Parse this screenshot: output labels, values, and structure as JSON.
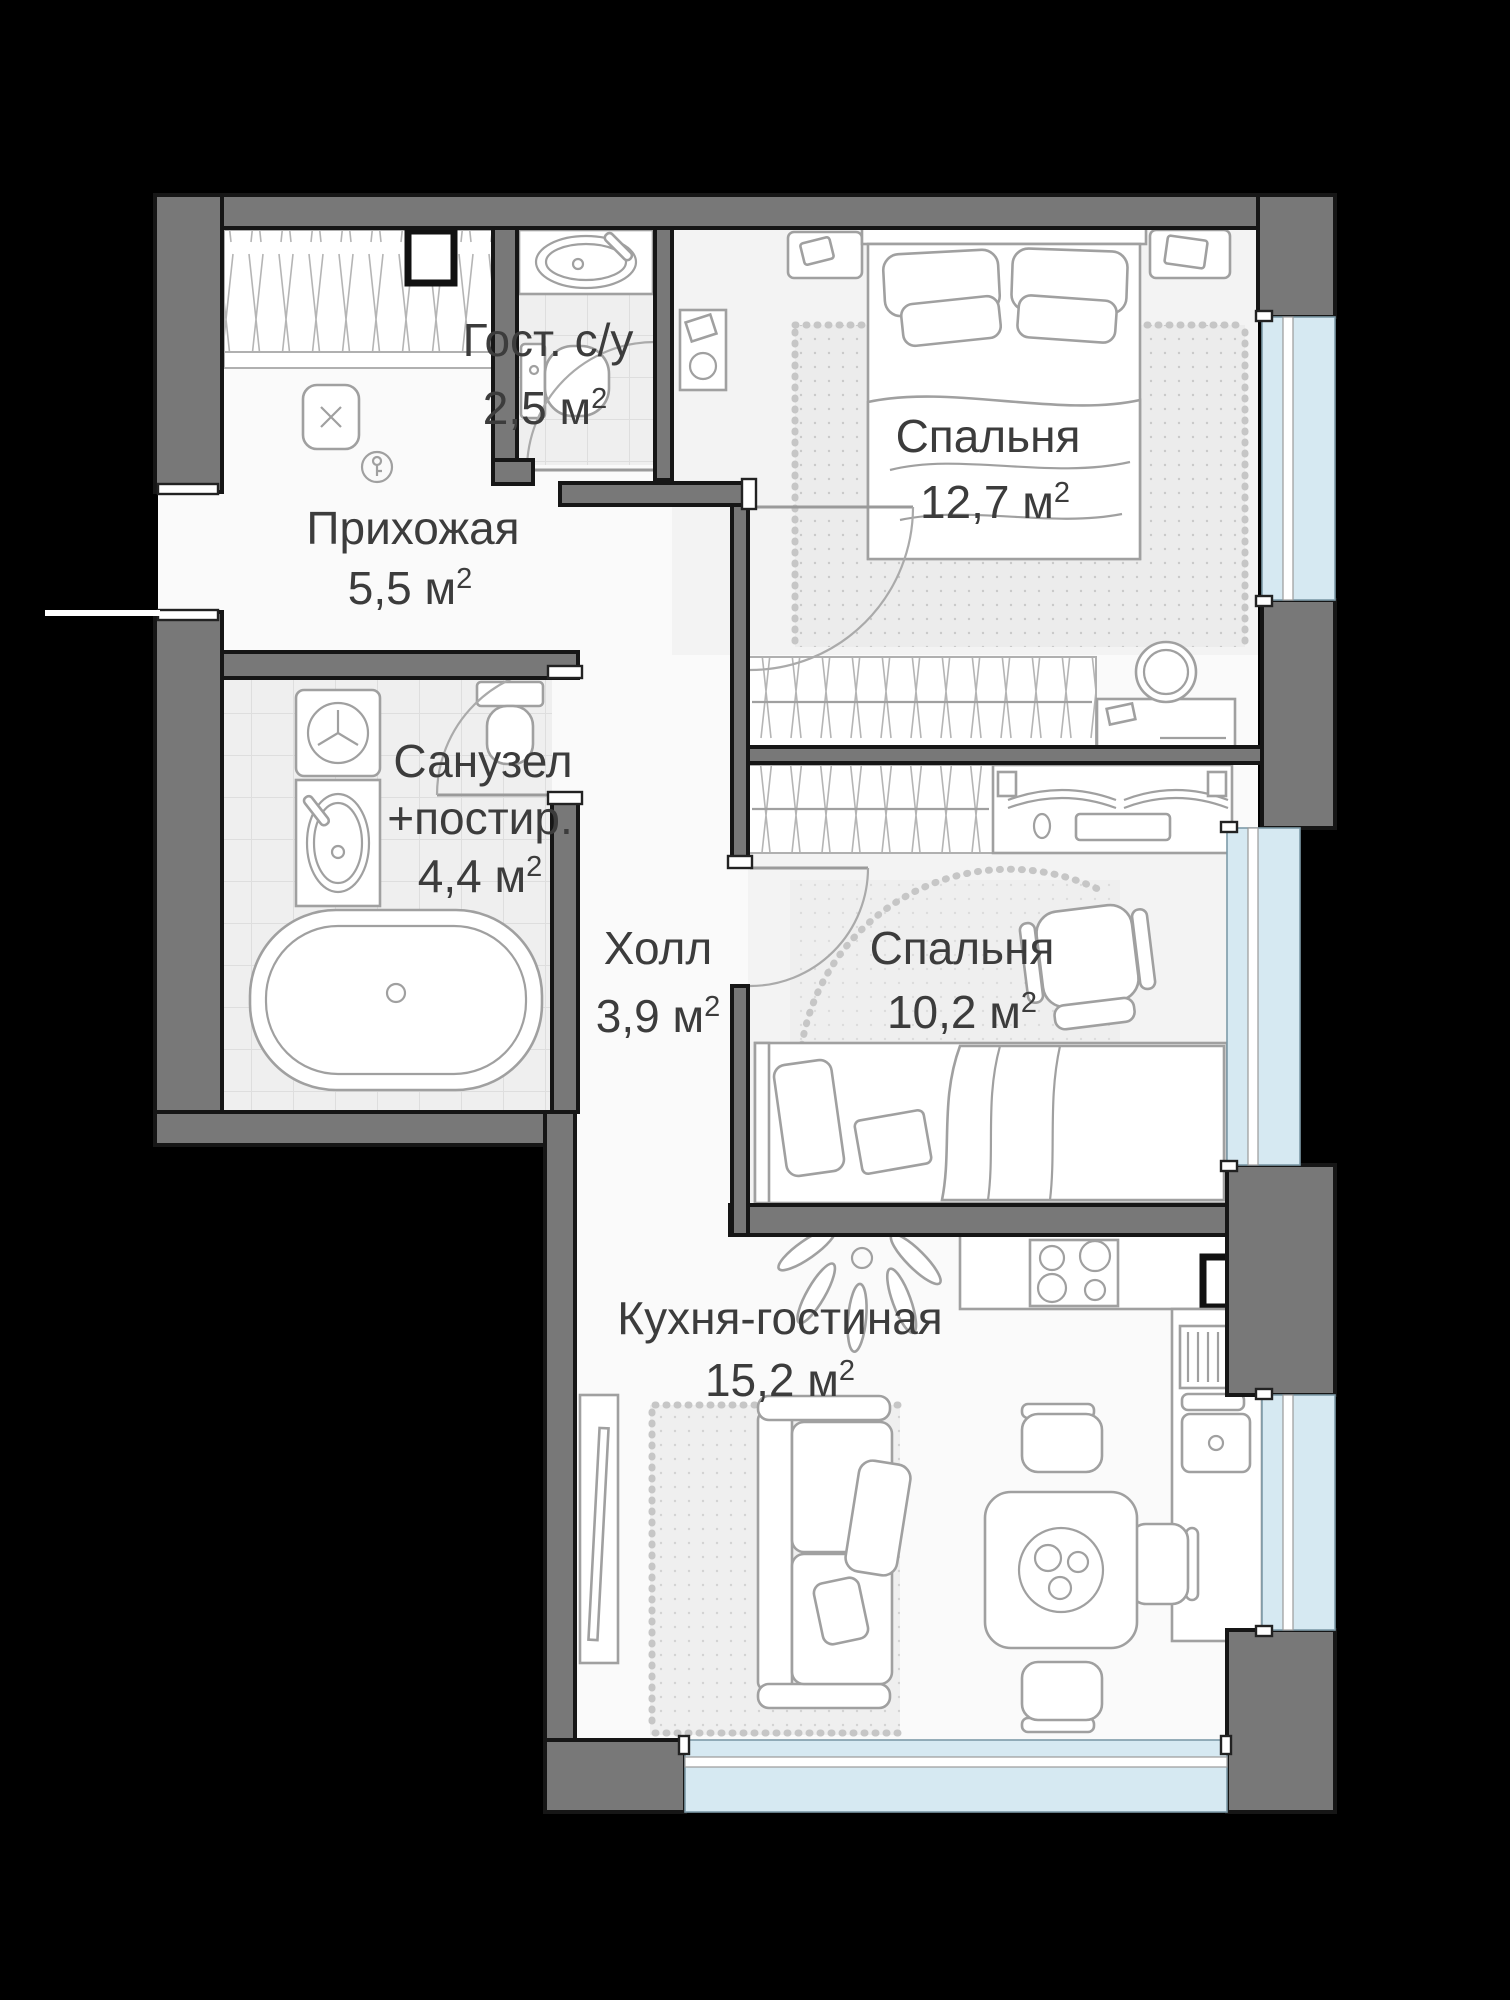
{
  "plan": {
    "rooms": {
      "guest_wc": {
        "name": "Гост. с/у",
        "area": "2,5 м",
        "area_sup": "2"
      },
      "hallway": {
        "name": "Прихожая",
        "area": "5,5 м",
        "area_sup": "2"
      },
      "bedroom1": {
        "name": "Спальня",
        "area": "12,7 м",
        "area_sup": "2"
      },
      "bathroom": {
        "name_line1": "Санузел",
        "name_line2": "+постир.",
        "area": "4,4 м",
        "area_sup": "2"
      },
      "hall": {
        "name": "Холл",
        "area": "3,9 м",
        "area_sup": "2"
      },
      "bedroom2": {
        "name": "Спальня",
        "area": "10,2 м",
        "area_sup": "2"
      },
      "kitchen": {
        "name": "Кухня-гостиная",
        "area": "15,2 м",
        "area_sup": "2"
      }
    },
    "colors": {
      "background": "#000000",
      "wall": "#787878",
      "wall_outline": "#161616",
      "floor": "#fafafa",
      "room_floor": "#f3f3f3",
      "window_glass": "#d6e9f2",
      "furniture_line": "#a0a0a0",
      "label": "#3c3c3c"
    }
  }
}
